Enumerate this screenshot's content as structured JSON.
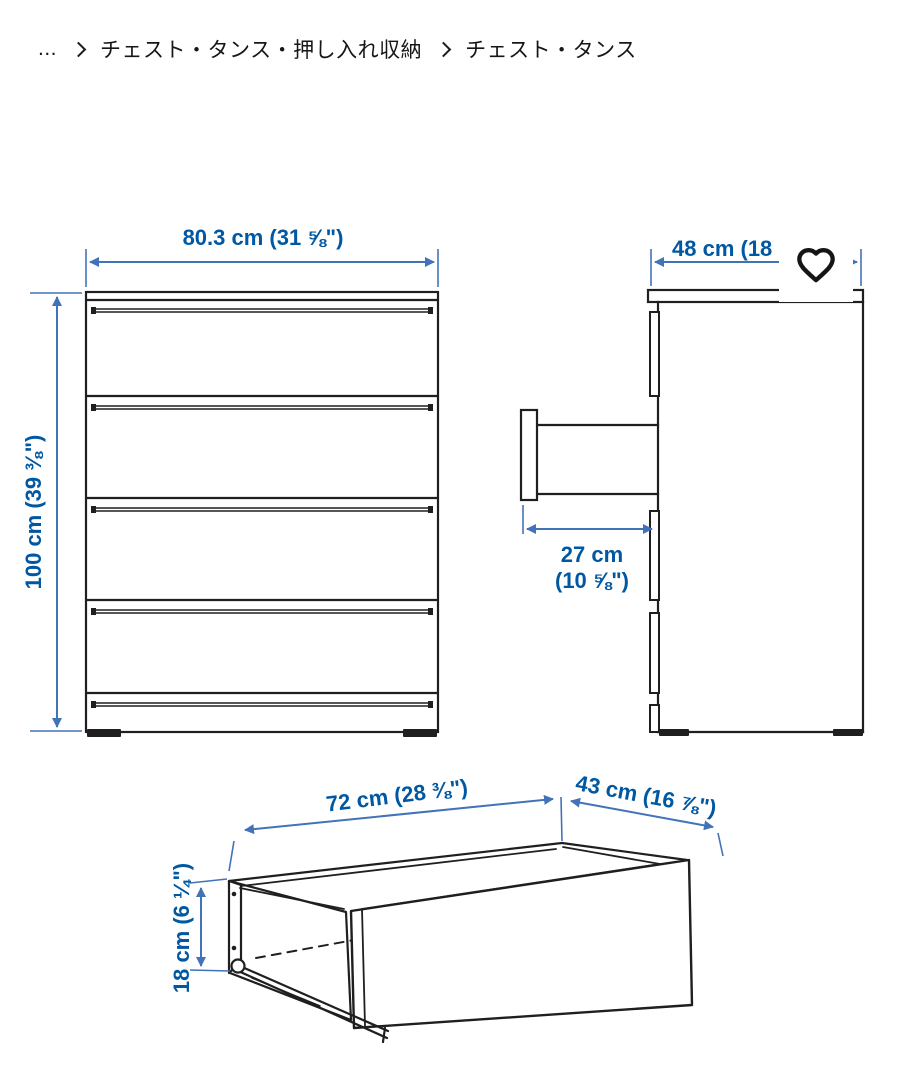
{
  "breadcrumb": {
    "collapsed": "...",
    "items": [
      {
        "label": "チェスト・タンス・押し入れ収納"
      },
      {
        "label": "チェスト・タンス"
      }
    ]
  },
  "favorite": {
    "icon": "heart-outline"
  },
  "diagram": {
    "front_view": {
      "width": "80.3 cm (31 ⅝\")",
      "height": "100 cm (39 ⅜\")"
    },
    "side_view": {
      "depth_truncated": "48 cm (18",
      "open_drawer_depth": [
        "27 cm",
        "(10 ⅝\")"
      ]
    },
    "drawer_view": {
      "inner_width": "72 cm (28 ⅜\")",
      "inner_depth": "43 cm (16 ⅞\")",
      "inner_height": "18 cm (6 ¼\")"
    }
  },
  "colors": {
    "dimension_text": "#0058a3",
    "dimension_line": "#4273b8",
    "line_art": "#1f1f1f",
    "breadcrumb_text": "#161616",
    "background": "#ffffff"
  }
}
